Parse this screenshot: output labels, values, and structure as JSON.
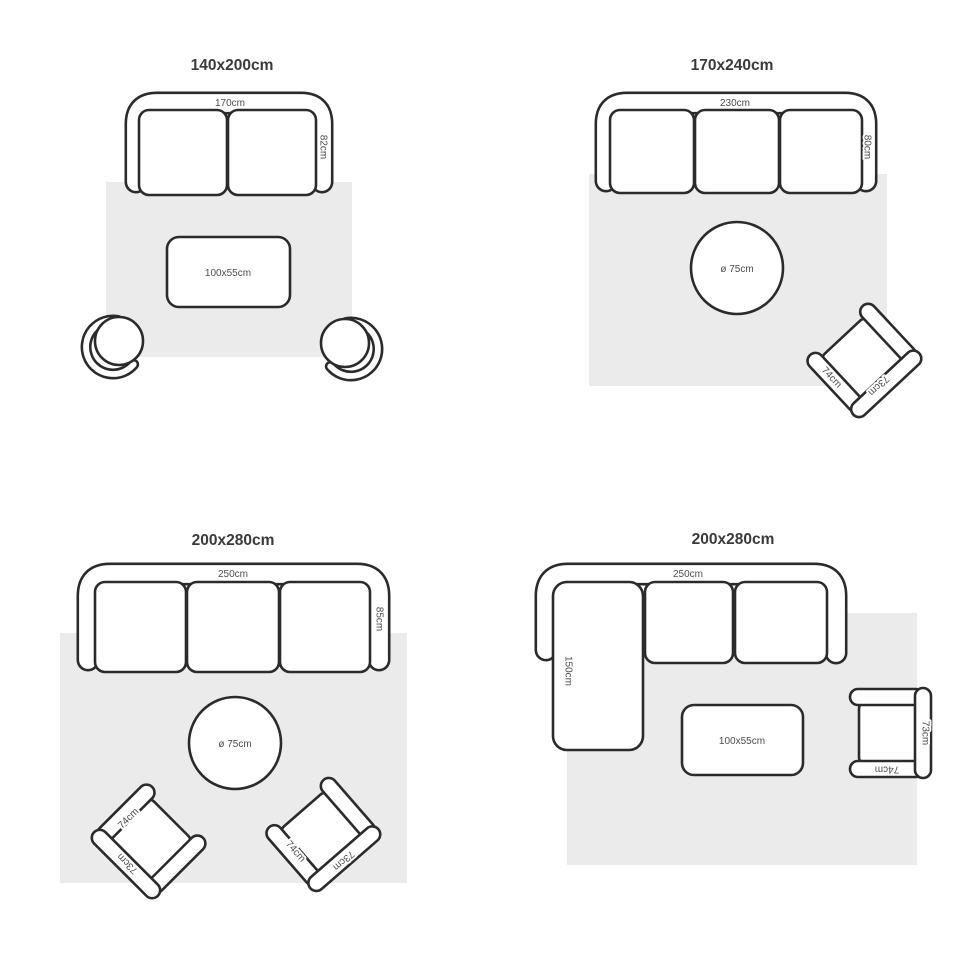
{
  "page": {
    "description": "Rug size guide with furniture layouts, 2x2 grid"
  },
  "colors": {
    "outline": "#2b2b2b",
    "rug_fill": "#ebebeb",
    "furniture_fill": "#ffffff",
    "title_text": "#3a3a3a",
    "label_text": "#4d4d4d",
    "page_bg": "#ffffff"
  },
  "quadrants": [
    {
      "id": "top-left",
      "title": "140x200cm",
      "rug_size": "140x200cm",
      "sofa": {
        "type": "2-seat sofa",
        "width_label": "170cm",
        "depth_label": "82cm"
      },
      "table": {
        "type": "rectangular coffee table",
        "label": "100x55cm"
      },
      "chairs": {
        "type": "round tub chair",
        "count": 2
      }
    },
    {
      "id": "top-right",
      "title": "170x240cm",
      "rug_size": "170x240cm",
      "sofa": {
        "type": "3-seat sofa",
        "width_label": "230cm",
        "depth_label": "80cm"
      },
      "table": {
        "type": "round coffee table",
        "label": "ø 75cm"
      },
      "armchair": {
        "type": "armchair rotated",
        "arm_label": "74cm",
        "back_label": "73cm"
      }
    },
    {
      "id": "bottom-left",
      "title": "200x280cm",
      "rug_size": "200x280cm",
      "sofa": {
        "type": "3-seat sofa",
        "width_label": "250cm",
        "depth_label": "85cm"
      },
      "table": {
        "type": "round coffee table",
        "label": "ø 75cm"
      },
      "armchairs": [
        {
          "type": "armchair rotated",
          "arm_label": "74cm",
          "back_label": "73cm"
        },
        {
          "type": "armchair rotated",
          "arm_label": "74cm",
          "back_label": "73cm"
        }
      ]
    },
    {
      "id": "bottom-right",
      "title": "200x280cm",
      "rug_size": "200x280cm",
      "sofa": {
        "type": "sectional sofa with chaise",
        "width_label": "250cm",
        "chaise_label": "150cm"
      },
      "table": {
        "type": "rectangular coffee table",
        "label": "100x55cm"
      },
      "armchair": {
        "type": "armchair",
        "arm_label": "74cm",
        "back_label": "73cm"
      }
    }
  ]
}
